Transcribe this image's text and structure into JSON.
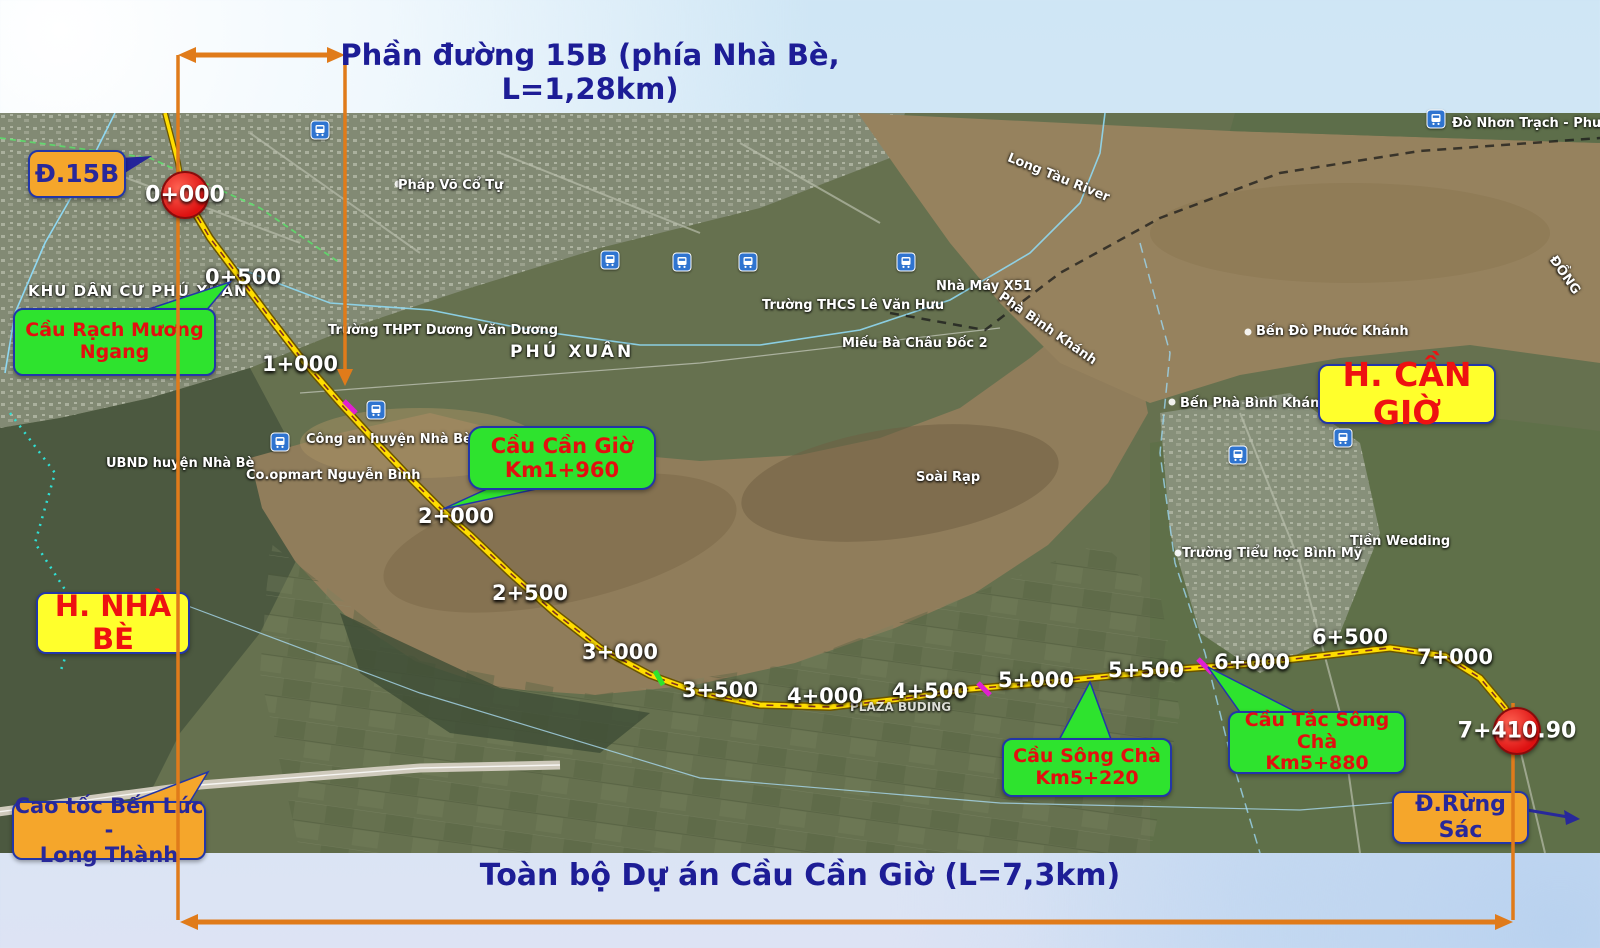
{
  "page": {
    "header_line1": "Phần đường 15B (phía Nhà Bè,",
    "header_line2": "L=1,28km)",
    "footer_title": "Toàn bộ Dự án Cầu Cần Giờ (L=7,3km)"
  },
  "colors": {
    "title_navy": "#1d1d96",
    "measure_orange": "#e07b1a",
    "callout_green": "#2ee32e",
    "callout_yellow": "#ffff2c",
    "callout_orange": "#f5a62b",
    "callout_red_text": "#e30f0f",
    "callout_navy_text": "#28289a",
    "marker_red": "#dd1111",
    "route_yellow": "#ffdd00"
  },
  "callouts": {
    "d15b": "Đ.15B",
    "rach_muong_line1": "Cầu Rạch Mương",
    "rach_muong_line2": "Ngang",
    "can_gio_line1": "Cầu Cần Giờ",
    "can_gio_line2": "Km1+960",
    "h_can_gio": "H. CẦN GIỜ",
    "h_nha_be": "H. NHÀ BÈ",
    "song_cha_line1": "Cầu Sông Chà",
    "song_cha_line2": "Km5+220",
    "tac_song_cha_line1": "Cầu Tắc Sông Chà",
    "tac_song_cha_line2": "Km5+880",
    "cao_toc_line1": "Cao tốc Bến Lức -",
    "cao_toc_line2": "Long Thành",
    "rung_sac": "Đ.Rừng Sác"
  },
  "markers": {
    "start": "0+000",
    "end": "7+410.90"
  },
  "map": {
    "km_markers": [
      "0+500",
      "1+000",
      "2+000",
      "2+500",
      "3+000",
      "3+500",
      "4+000",
      "4+500",
      "5+000",
      "5+500",
      "6+000",
      "6+500",
      "7+000"
    ],
    "place_labels": [
      "KHU DÂN CƯ PHÚ XUÂN",
      "Pháp Võ Cổ Tự",
      "Trường THPT Dương Văn Dương",
      "PHÚ XUÂN",
      "Công an huyện Nhà Bè",
      "UBND huyện Nhà Bè",
      "Co.opmart Nguyễn Bình",
      "Trường THCS Lê Văn Hưu",
      "Miếu Bà Châu Đốc 2",
      "Nhà Máy X51",
      "Phà Bình Khánh",
      "Long Tàu River",
      "Đò Nhơn Trạch - Phước Kh",
      "Bến Đò Phước Khánh",
      "Bến Phà Bình Khánh",
      "Soài Rạp",
      "Trường Tiểu học Bình Mỹ",
      "Tiền Wedding",
      "PLAZA BUDING",
      "ĐỒNG"
    ]
  }
}
